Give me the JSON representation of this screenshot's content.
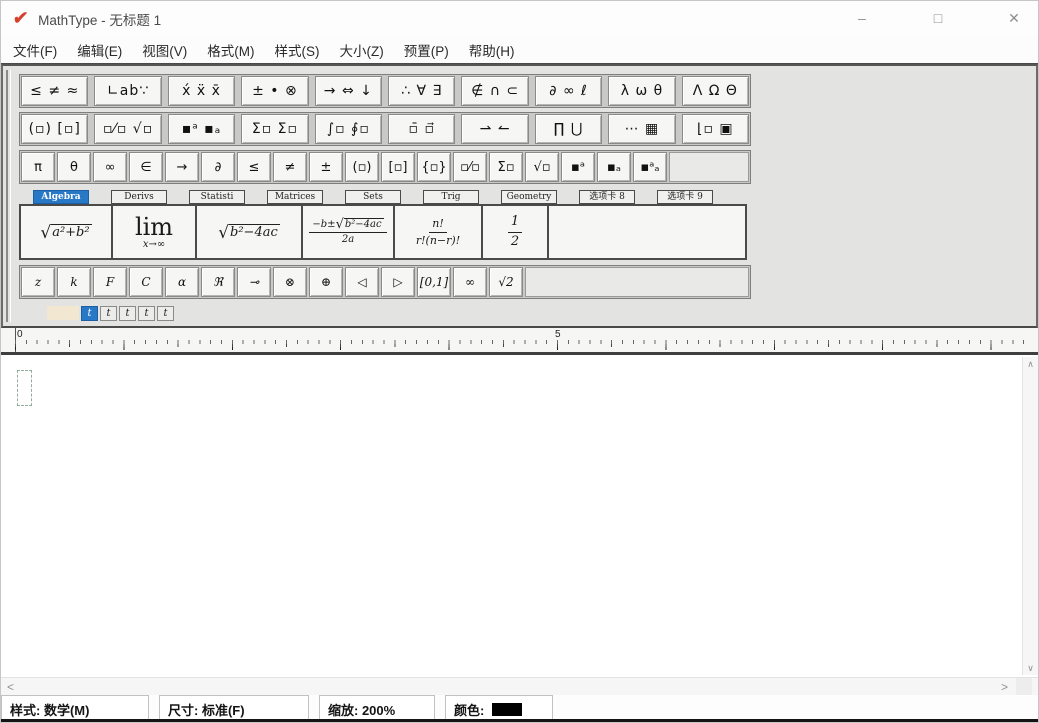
{
  "window": {
    "logo_glyph": "✔",
    "title": "MathType - 无标题 1",
    "minimize": "–",
    "maximize": "□",
    "close": "✕"
  },
  "menu": [
    "文件(F)",
    "编辑(E)",
    "视图(V)",
    "格式(M)",
    "样式(S)",
    "大小(Z)",
    "预置(P)",
    "帮助(H)"
  ],
  "toolbar": {
    "symbol_palettes": [
      "≤ ≠ ≈",
      "∟ab∵",
      "x́ ẍ x̄",
      "± • ⊗",
      "→ ⇔ ↓",
      "∴ ∀ ∃",
      "∉ ∩ ⊂",
      "∂ ∞ ℓ",
      "λ ω θ",
      "Λ Ω Θ"
    ],
    "template_palettes": [
      "(▫) [▫]",
      "▫⁄▫ √▫",
      "▪ᵃ ▪ₐ",
      "Σ▫ Σ▫",
      "∫▫ ∮▫",
      "▫̄ ▫⃗",
      "⇀ ↼",
      "∏ ⋃",
      "⋯ ▦",
      "⌊▫ ▣"
    ],
    "quick_symbols": [
      "π",
      "θ",
      "∞",
      "∈",
      "→",
      "∂",
      "≤",
      "≠",
      "±",
      "(▫)",
      "[▫]",
      "{▫}",
      "▫⁄▫",
      "Σ▫",
      "√▫",
      "▪ᵃ",
      "▪ₐ",
      "▪ᵃₐ"
    ],
    "tabs": [
      {
        "label": "Algebra",
        "active": true
      },
      {
        "label": "Derivs",
        "active": false
      },
      {
        "label": "Statisti",
        "active": false
      },
      {
        "label": "Matrices",
        "active": false
      },
      {
        "label": "Sets",
        "active": false
      },
      {
        "label": "Trig",
        "active": false
      },
      {
        "label": "Geometry",
        "active": false
      },
      {
        "label": "选项卡 8",
        "active": false
      },
      {
        "label": "选项卡 9",
        "active": false
      }
    ],
    "expressions": {
      "e1": {
        "sign": "√",
        "body": "a²+b²"
      },
      "e2": {
        "main": "lim",
        "sub": "x→∞"
      },
      "e3": {
        "sign": "√",
        "body": "b²−4ac"
      },
      "e4": {
        "pre": "−b±",
        "sign": "√",
        "rad": "b²−4ac",
        "den": "2a"
      },
      "e5": {
        "num": "n!",
        "den": "r!(n−r)!"
      },
      "e6": {
        "num": "1",
        "den": "2"
      }
    },
    "quick_letters": [
      "z",
      "k",
      "F",
      "C",
      "α",
      "ℜ",
      "⊸",
      "⊗",
      "⊕",
      "◁",
      "▷",
      "[0,1]",
      "∞",
      "√2"
    ],
    "size_tabs": [
      {
        "label": "t",
        "active": true
      },
      {
        "label": "t",
        "active": false
      },
      {
        "label": "t",
        "active": false
      },
      {
        "label": "t",
        "active": false
      },
      {
        "label": "t",
        "active": false
      }
    ]
  },
  "ruler": {
    "label_0": "0",
    "label_5": "5"
  },
  "scrollbar": {
    "up": "∧",
    "down": "∨",
    "left": "<",
    "right": ">"
  },
  "statusbar": {
    "style": "样式: 数学(M)",
    "size": "尺寸: 标准(F)",
    "zoom": "缩放: 200%",
    "color_label": "颜色:",
    "color_value": "#000000"
  },
  "colors": {
    "accent": "#2878c8",
    "logo_red": "#d6402f",
    "swatch": "#000000"
  }
}
